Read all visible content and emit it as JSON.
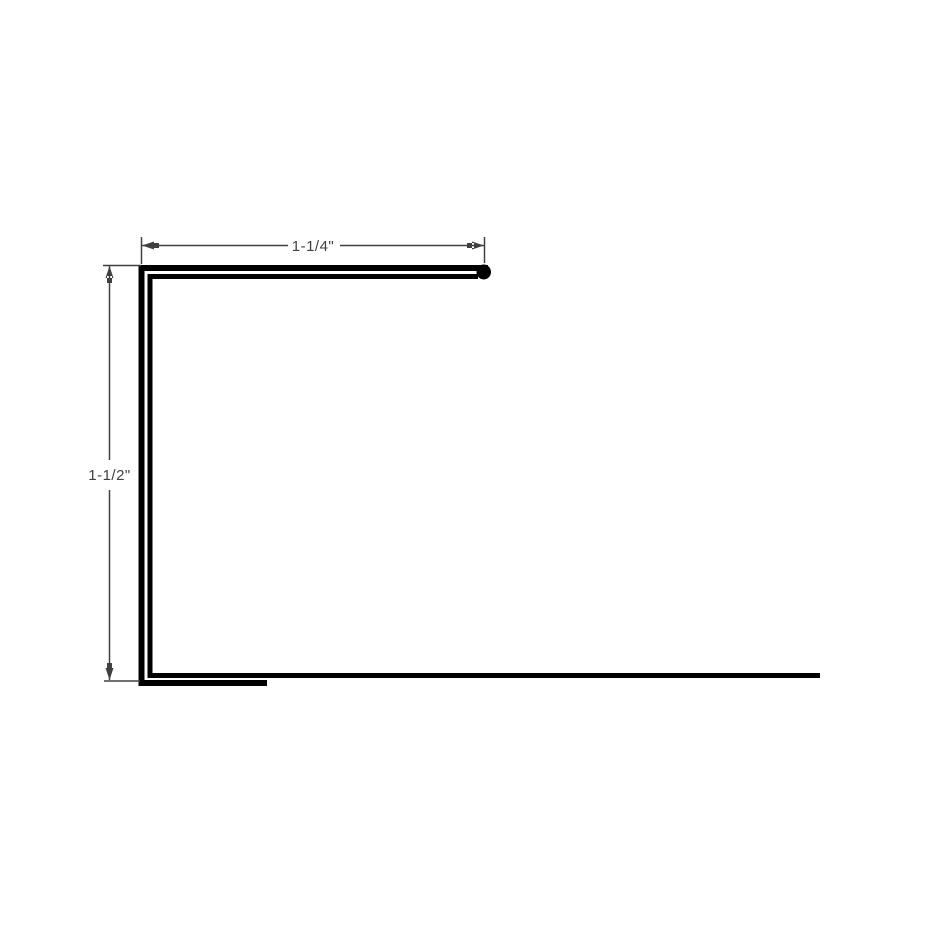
{
  "drawing": {
    "colors": {
      "background": "#ffffff",
      "profile_line": "#000000",
      "dimension": "#404040"
    },
    "dimensions": [
      {
        "id": "top-width",
        "orientation": "horizontal",
        "label": "1-1/4\""
      },
      {
        "id": "left-height",
        "orientation": "vertical",
        "label": "1-1/2\""
      }
    ]
  }
}
